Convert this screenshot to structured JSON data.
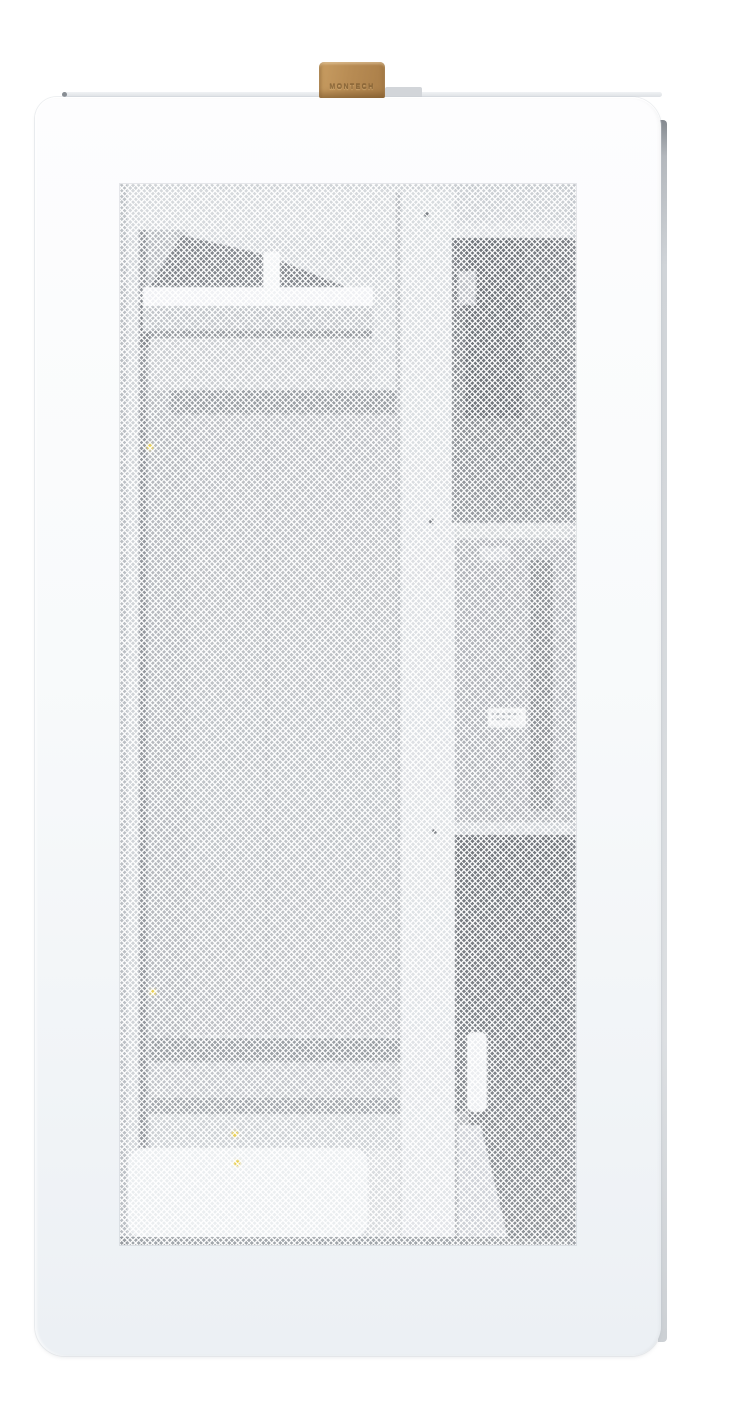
{
  "meta": {
    "subject": "white PC case side view with mesh panel and leather pull strap"
  },
  "strap": {
    "label": "MONTECH"
  },
  "colors": {
    "page_bg": "#ffffff",
    "panel": "#f7f9fb",
    "strap": "#b5894f",
    "strap_text": "#7d5c31",
    "mesh_interior": "#c9cdd2",
    "interior_dark": "#5e636a",
    "accent_yellow": "#e7c93a"
  }
}
